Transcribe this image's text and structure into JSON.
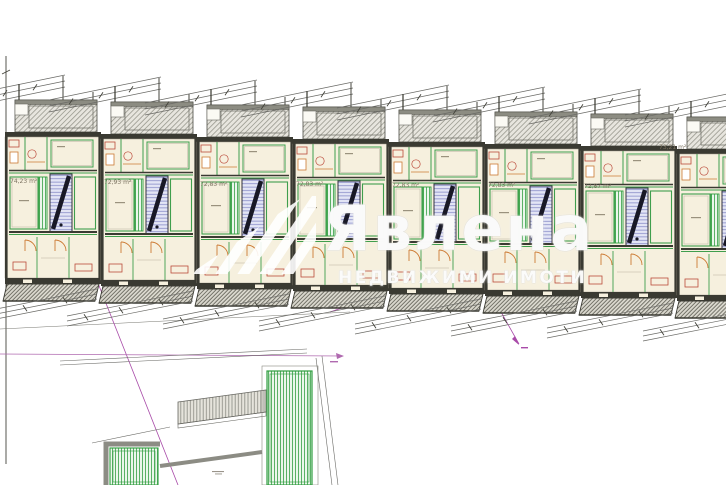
{
  "watermark": {
    "brand": "Явлена",
    "tagline": "НЕДВИЖИМИ ИМОТИ",
    "logo": "stripes-flag-icon"
  },
  "units": [
    {
      "area_label": "74,23 m²",
      "x": 5,
      "y": 92,
      "label_x": 10,
      "label_y": 179
    },
    {
      "area_label": "72,93 m²",
      "x": 101,
      "y": 94,
      "label_x": 104,
      "label_y": 180
    },
    {
      "area_label": "72,83 m²",
      "x": 197,
      "y": 97,
      "label_x": 200,
      "label_y": 182
    },
    {
      "area_label": "72,83 m²",
      "x": 293,
      "y": 99,
      "label_x": 296,
      "label_y": 182
    },
    {
      "area_label": "72,83 m²",
      "x": 389,
      "y": 102,
      "label_x": 392,
      "label_y": 183
    },
    {
      "area_label": "72,83 m²",
      "x": 485,
      "y": 104,
      "label_x": 488,
      "label_y": 183
    },
    {
      "area_label": "72,87 m²",
      "x": 581,
      "y": 106,
      "label_x": 584,
      "label_y": 184
    },
    {
      "area_label": "73,21 m²",
      "x": 677,
      "y": 109,
      "label_x": 659,
      "label_y": 145
    }
  ],
  "colors": {
    "room_fill": "#f6f0de",
    "partition_green": "#3f9e4d",
    "hatch_green": "#4aa957",
    "wall_dark": "#3a3a32",
    "stair_blue": "#7f84c4",
    "reference_magenta": "#a84aa8",
    "furniture_red": "#bb4a3a",
    "furniture_orange": "#cc7a33"
  }
}
